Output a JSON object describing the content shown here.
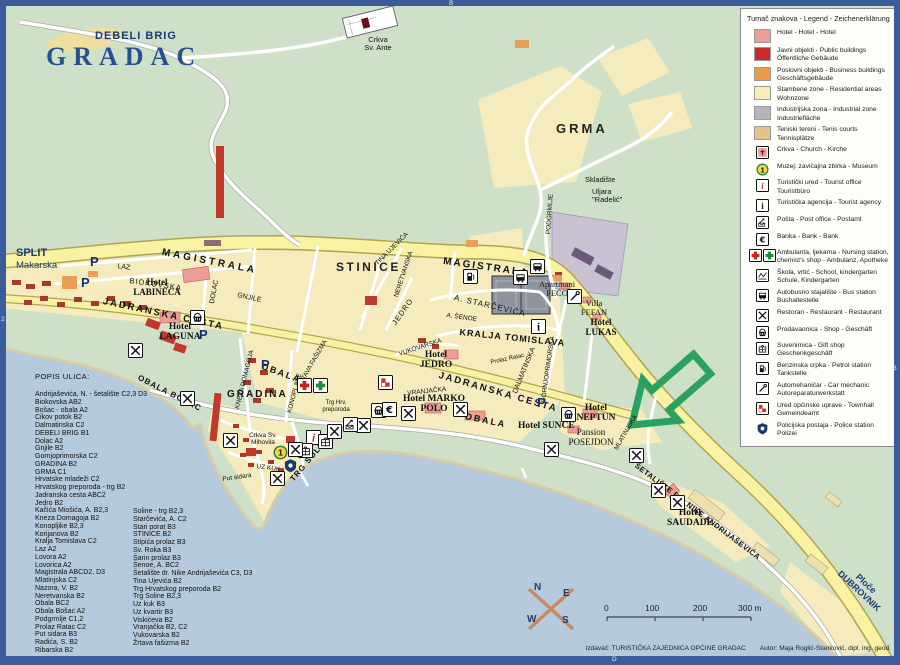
{
  "title": "GRADAC",
  "grid_labels": {
    "top": "B",
    "bottom": "D",
    "left": "2",
    "right": "3"
  },
  "colors": {
    "sea": "#b5cbdd",
    "land": "#cfe0c8",
    "road_yellow": "#f8f2a2",
    "residential": "#f5ebbc",
    "arrow_green": "#2aa061",
    "frame_blue": "#3b5b9b",
    "hotel_pink": "#ee9c96",
    "public_red": "#cc2a26",
    "business_orange": "#eb9a4d",
    "industrial_gray": "#b9b3bd",
    "tennis_tan": "#e7c08a"
  },
  "legend": {
    "title": "Tumač znakova - Legend - Zeichenerklärung",
    "items": [
      {
        "swatch": "#ee9c96",
        "name": "hotel",
        "label": "Hotel - Hotel - Hotel"
      },
      {
        "swatch": "#cc2a26",
        "name": "public-buildings",
        "label": "Javni objekti - Public buildings\nÖffentliche Gebäude"
      },
      {
        "swatch": "#eb9a4d",
        "name": "business-buildings",
        "label": "Poslovni objekti - Business buildings\nGeschäftsgebäude"
      },
      {
        "swatch": "#f6ecb4",
        "name": "residential",
        "label": "Stambene zone - Residential areas\nWohnzone"
      },
      {
        "swatch": "#b9b3bd",
        "name": "industrial",
        "label": "Industrijska zona - Industrial zone\nIndustriefläche"
      },
      {
        "swatch": "#e7c08a",
        "name": "tennis",
        "label": "Teniski tereni - Tenis courts\nTennisplätze"
      },
      {
        "icon": "church",
        "label": "Crkva - Church - Kirche"
      },
      {
        "icon": "museum",
        "label": "Muzej: zavičajna zbirka - Museum"
      },
      {
        "icon": "tourist_office",
        "label": "Turistički ured - Tourist office\nTouristbüro"
      },
      {
        "icon": "tourist_agency",
        "label": "Turistička agencija - Tourist agency"
      },
      {
        "icon": "post",
        "label": "Pošta - Post office - Postamt"
      },
      {
        "icon": "bank",
        "label": "Banka - Bank - Bank"
      },
      {
        "icon": "ambulance",
        "label": "Ambulanta, ljekarna - Nursing station,\nchemist's shop - Ambulanz, Apotheke"
      },
      {
        "icon": "school",
        "label": "Škola, vrtić - School, kindergarten\nSchule, Kindergarten"
      },
      {
        "icon": "bus",
        "label": "Autobusno stajalište - Bus station\nBushaltestelle"
      },
      {
        "icon": "restaurant",
        "label": "Restoran - Restaurant - Restaurant"
      },
      {
        "icon": "shop",
        "label": "Prodavaonica - Shop - Geschäft"
      },
      {
        "icon": "gift",
        "label": "Suvenirnica - Gift shop\nGeschenkgeschäft"
      },
      {
        "icon": "petrol",
        "label": "Benzinska crpka - Petrol station\nTankstelle"
      },
      {
        "icon": "mechanic",
        "label": "Automehaničar - Car mechanic\nAutoreparaturwerkstatt"
      },
      {
        "icon": "townhall",
        "label": "Ured općinske uprave - Townhall\nGemeindeamt"
      },
      {
        "icon": "police",
        "label": "Policijska postaja - Police station\nPolizei"
      }
    ]
  },
  "street_index": {
    "title": "POPIS ULICA:",
    "column1": [
      "Andrijaševića, N. - šetalište  C2,3 D3",
      "Biokovska  AB2",
      "Bošac - obala  A2",
      "Cikov potok  B2",
      "Dalmatinska  C2",
      "DEBELI BRIG  B1",
      "Dolac  A2",
      "Gnjile  B2",
      "Gornjoprimorska  C2",
      "GRADINA  B2",
      "GRMA  C1",
      "Hrvatske mladeži  C2",
      "Hrvatskog preporoda - trg  B2",
      "Jadranska cesta  ABC2",
      "Jedro  B2",
      "Kačića Miošića, A.  B2,3",
      "Kneza Domagoja B2",
      "Konopljike  B2,3",
      "Korijanova  B2",
      "Kralja Tomislava C2",
      "Laz A2",
      "Lovora  A2",
      "Lovorica  A2",
      "Magistrala  ABCD2, D3",
      "Mlatinjska  C2",
      "Nazora, V.  B2",
      "Neretvanska B2",
      "Obala  BC2",
      "Obala Bošac  A2",
      "Podgrmlje C1,2",
      "Prolaz Ratac  C2",
      "Put sidara  B3",
      "Radića, S.  B2",
      "Ribarska B2"
    ],
    "column2": [
      "Soline - trg  B2,3",
      "Starčevića, A.  C2",
      "Stari porat  B3",
      "STINICE  B2",
      "Stipića prolaz  B3",
      "Sv. Roka B3",
      "Šarin prolaz B3",
      "Šenoe, A.  BC2",
      "Šetalište dr. Nike Andrijaševića  C3, D3",
      "Tina Ujevića B2",
      "Trg Hrvatskog preporoda  B2",
      "Trg Soline  B2,3",
      "Uz kuk  B3",
      "Uz kvartir B3",
      "Viskićeva  B2",
      "Vranjačka  B2, C2",
      "Vukovarska  B2",
      "Žrtava fašizma  B2"
    ]
  },
  "map": {
    "parking_label": "P",
    "museum_number": "1",
    "labels": [
      {
        "t": "DEBELI BRIG",
        "x": 95,
        "y": 30,
        "s": 11,
        "w": 700,
        "c": "#1a3a74",
        "ls": 1
      },
      {
        "t": "Crkva\nSv. Ante",
        "x": 378,
        "y": 36,
        "s": 7.5,
        "a": "center"
      },
      {
        "t": "GRMA",
        "x": 556,
        "y": 122,
        "s": 13,
        "w": 700,
        "ls": 3,
        "c": "#222"
      },
      {
        "t": "Skladište",
        "x": 585,
        "y": 176,
        "s": 7.5
      },
      {
        "t": "Uljara\n\"Radelić\"",
        "x": 592,
        "y": 188,
        "s": 7.5
      },
      {
        "t": "SPLIT",
        "x": 16,
        "y": 247,
        "s": 11,
        "w": 700,
        "c": "#1a3a74"
      },
      {
        "t": "Makarska",
        "x": 16,
        "y": 261,
        "s": 9.5,
        "c": "#1a3a74"
      },
      {
        "t": "MAGISTRALA",
        "x": 163,
        "y": 247,
        "r": 11,
        "s": 10,
        "w": 700,
        "ls": 3
      },
      {
        "t": "MAGISTRALA",
        "x": 444,
        "y": 256,
        "r": 8,
        "s": 10,
        "w": 700,
        "ls": 2
      },
      {
        "t": "STINICE",
        "x": 336,
        "y": 261,
        "s": 12,
        "w": 700,
        "ls": 2.5,
        "c": "#222"
      },
      {
        "t": "LAZ",
        "x": 118,
        "y": 263,
        "r": 8,
        "s": 7
      },
      {
        "t": "BIOKOVSKA",
        "x": 130,
        "y": 277,
        "r": 8,
        "s": 7.5,
        "ls": 1
      },
      {
        "t": "JADRANSKA CESTA",
        "x": 104,
        "y": 297,
        "r": 12,
        "s": 9.5,
        "w": 700,
        "ls": 2
      },
      {
        "t": "JADRANSKA CESTA",
        "x": 440,
        "y": 371,
        "r": 16,
        "s": 9.5,
        "w": 700,
        "ls": 2
      },
      {
        "t": "DOLAC",
        "x": 209,
        "y": 303,
        "r": -80,
        "s": 7
      },
      {
        "t": "GNJILE",
        "x": 238,
        "y": 292,
        "r": 12,
        "s": 7
      },
      {
        "t": "GRADINA",
        "x": 227,
        "y": 389,
        "s": 10,
        "w": 700,
        "ls": 2
      },
      {
        "t": "ŽRTAVA FAŠIZMA",
        "x": 296,
        "y": 385,
        "r": -60,
        "s": 6.5
      },
      {
        "t": "TINA UJEVIĆA",
        "x": 374,
        "y": 262,
        "r": -45,
        "s": 6.5
      },
      {
        "t": "NERETVANSKA",
        "x": 393,
        "y": 296,
        "r": -72,
        "s": 6.5
      },
      {
        "t": "VUKOVARSKA",
        "x": 398,
        "y": 351,
        "r": -18,
        "s": 6.5
      },
      {
        "t": "JEDRO",
        "x": 391,
        "y": 322,
        "r": -55,
        "s": 7.5,
        "ls": 1
      },
      {
        "t": "KNEZA DOMAGOJA",
        "x": 234,
        "y": 408,
        "r": -76,
        "s": 6.5
      },
      {
        "t": "A. STARČEVIĆA",
        "x": 455,
        "y": 294,
        "r": 13,
        "s": 8,
        "ls": 1
      },
      {
        "t": "A. ŠENOE",
        "x": 447,
        "y": 312,
        "r": 8,
        "s": 6.5
      },
      {
        "t": "KRALJA TOMISLAVA",
        "x": 460,
        "y": 328,
        "r": 6,
        "s": 9,
        "w": 600,
        "ls": 1
      },
      {
        "t": "Hotel\nLABINECA",
        "x": 157,
        "y": 278,
        "s": 9,
        "f": "serif",
        "a": "center",
        "w": 600
      },
      {
        "t": "Hotel\nLAGUNA",
        "x": 180,
        "y": 322,
        "s": 9.5,
        "f": "serif",
        "a": "center",
        "w": 600
      },
      {
        "t": "Hotel\nJEDRO",
        "x": 436,
        "y": 350,
        "s": 9.5,
        "f": "serif",
        "a": "center",
        "w": 600
      },
      {
        "t": "Hotel MARKO\nPOLO",
        "x": 434,
        "y": 394,
        "s": 9.5,
        "f": "serif",
        "a": "center",
        "w": 600
      },
      {
        "t": "Hotel SUNCE",
        "x": 518,
        "y": 421,
        "s": 9.5,
        "f": "serif",
        "w": 600
      },
      {
        "t": "Hotel\nNEPTUN",
        "x": 596,
        "y": 403,
        "s": 9.5,
        "f": "serif",
        "a": "center",
        "w": 600
      },
      {
        "t": "Pansion\nPOSEJDON",
        "x": 591,
        "y": 428,
        "s": 9,
        "f": "serif",
        "a": "center"
      },
      {
        "t": "MLATINJSKA",
        "x": 613,
        "y": 448,
        "r": -60,
        "s": 6.5
      },
      {
        "t": "ŠETALIŠTE DR. NIKE ANDRIJAŠEVIĆA",
        "x": 638,
        "y": 462,
        "r": 37,
        "s": 7.5,
        "w": 600,
        "ls": 0.5
      },
      {
        "t": "Hotel\nSAUDADE",
        "x": 690,
        "y": 508,
        "s": 9.5,
        "f": "serif",
        "a": "center",
        "w": 600
      },
      {
        "t": "Ploče\nDUBROVNIK",
        "x": 862,
        "y": 578,
        "r": 43,
        "s": 9,
        "w": 700,
        "c": "#1a3a74",
        "a": "center"
      },
      {
        "t": "OBALA",
        "x": 263,
        "y": 362,
        "r": 20,
        "s": 9,
        "w": 700,
        "ls": 2
      },
      {
        "t": "OBALA",
        "x": 466,
        "y": 412,
        "r": 12,
        "s": 9,
        "w": 700,
        "ls": 2
      },
      {
        "t": "OBALA BOŠAC",
        "x": 140,
        "y": 374,
        "r": 27,
        "s": 8,
        "w": 600,
        "ls": 1
      },
      {
        "t": "KONOPLJIKE",
        "x": 286,
        "y": 412,
        "r": -75,
        "s": 6.5
      },
      {
        "t": "Crkva Sv.\nMihovila",
        "x": 263,
        "y": 432,
        "s": 6.5,
        "a": "center"
      },
      {
        "t": "UZ KUK",
        "x": 257,
        "y": 463,
        "r": 8,
        "s": 6.5
      },
      {
        "t": "Put sidara",
        "x": 222,
        "y": 476,
        "r": -8,
        "s": 6.5
      },
      {
        "t": "TRG SOLINE",
        "x": 289,
        "y": 478,
        "r": -50,
        "s": 8,
        "w": 600,
        "ls": 1
      },
      {
        "t": "Trg Hrv.\npreporoda",
        "x": 336,
        "y": 400,
        "s": 6,
        "a": "center"
      },
      {
        "t": "VRANJAČKA",
        "x": 407,
        "y": 390,
        "r": -6,
        "s": 6.5
      },
      {
        "t": "Apartmani\nPEĆO",
        "x": 557,
        "y": 280,
        "s": 8.5,
        "f": "serif",
        "a": "center"
      },
      {
        "t": "Villa\nFEFAN",
        "x": 594,
        "y": 299,
        "s": 8.5,
        "f": "serif",
        "a": "center"
      },
      {
        "t": "Hotel\nLUKAS",
        "x": 601,
        "y": 318,
        "s": 9,
        "f": "serif",
        "a": "center",
        "w": 600
      },
      {
        "t": "PODGRMLJE",
        "x": 545,
        "y": 234,
        "r": -86,
        "s": 6.5
      },
      {
        "t": "GORNJOPRIMORSKA",
        "x": 540,
        "y": 402,
        "r": -82,
        "s": 6.5
      },
      {
        "t": "DALMATINSKA",
        "x": 512,
        "y": 392,
        "r": -68,
        "s": 7
      },
      {
        "t": "Prolaz Ratac",
        "x": 490,
        "y": 360,
        "r": -12,
        "s": 6
      }
    ],
    "icons": [
      {
        "type": "parking",
        "x": 97,
        "y": 263
      },
      {
        "type": "parking",
        "x": 88,
        "y": 284
      },
      {
        "type": "parking",
        "x": 206,
        "y": 336
      },
      {
        "type": "parking",
        "x": 268,
        "y": 366
      },
      {
        "type": "parking",
        "x": 544,
        "y": 404
      },
      {
        "type": "bus",
        "x": 537,
        "y": 266
      },
      {
        "type": "bus",
        "x": 520,
        "y": 277
      },
      {
        "type": "petrol",
        "x": 470,
        "y": 276
      },
      {
        "type": "mechanic",
        "x": 574,
        "y": 296
      },
      {
        "type": "tourist_agency",
        "x": 538,
        "y": 326
      },
      {
        "type": "tourist_office",
        "x": 313,
        "y": 437
      },
      {
        "type": "gift",
        "x": 325,
        "y": 441
      },
      {
        "type": "gift",
        "x": 305,
        "y": 450
      },
      {
        "type": "restaurant",
        "x": 135,
        "y": 350
      },
      {
        "type": "restaurant",
        "x": 187,
        "y": 398
      },
      {
        "type": "restaurant",
        "x": 230,
        "y": 440
      },
      {
        "type": "restaurant",
        "x": 295,
        "y": 449
      },
      {
        "type": "restaurant",
        "x": 277,
        "y": 478
      },
      {
        "type": "restaurant",
        "x": 334,
        "y": 431
      },
      {
        "type": "restaurant",
        "x": 363,
        "y": 425
      },
      {
        "type": "restaurant",
        "x": 408,
        "y": 413
      },
      {
        "type": "restaurant",
        "x": 460,
        "y": 409
      },
      {
        "type": "restaurant",
        "x": 551,
        "y": 449
      },
      {
        "type": "restaurant",
        "x": 636,
        "y": 455
      },
      {
        "type": "restaurant",
        "x": 658,
        "y": 490
      },
      {
        "type": "restaurant",
        "x": 677,
        "y": 502
      },
      {
        "type": "post",
        "x": 350,
        "y": 424
      },
      {
        "type": "shop",
        "x": 378,
        "y": 410
      },
      {
        "type": "shop",
        "x": 568,
        "y": 414
      },
      {
        "type": "shop",
        "x": 197,
        "y": 317
      },
      {
        "type": "bank",
        "x": 389,
        "y": 409
      },
      {
        "type": "museum",
        "x": 280,
        "y": 452
      },
      {
        "type": "police",
        "x": 290,
        "y": 465
      },
      {
        "type": "townhall",
        "x": 385,
        "y": 382
      },
      {
        "type": "ambulance",
        "x": 312,
        "y": 385
      }
    ]
  },
  "compass": {
    "n": "N",
    "e": "E",
    "s": "S",
    "w": "W"
  },
  "scale_bar": {
    "labels": [
      {
        "t": "0",
        "x": 604
      },
      {
        "t": "100",
        "x": 645
      },
      {
        "t": "200",
        "x": 693
      },
      {
        "t": "300 m",
        "x": 738
      }
    ]
  },
  "footer": {
    "publisher": "Izdavač: TURISTIČKA ZAJEDNICA OPĆINE GRADAC",
    "author": "Autor: Maja Roglić-Stanković, dipl. ing. geod."
  }
}
